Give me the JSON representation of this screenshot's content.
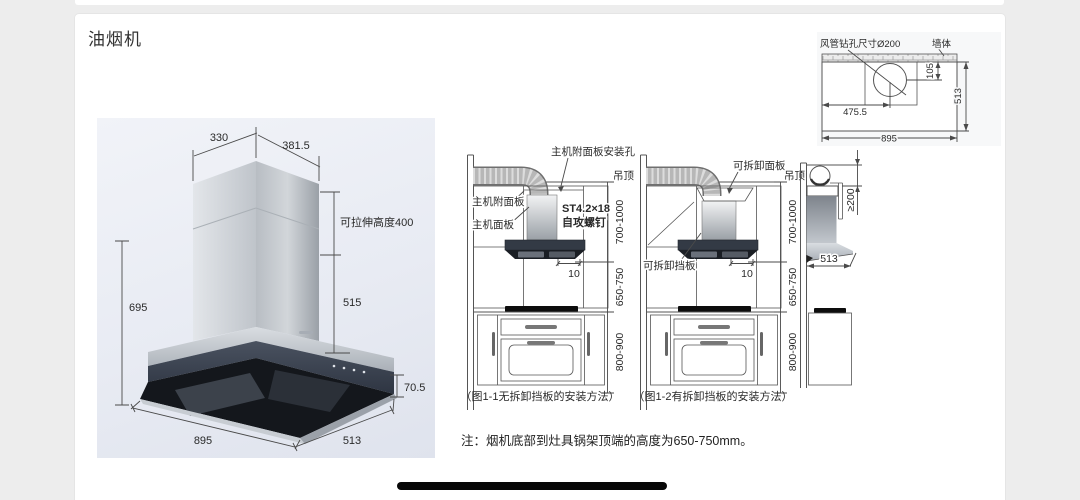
{
  "window": {
    "title": "油烟机"
  },
  "note": "注：烟机底部到灶具锅架顶端的高度为650-750mm。",
  "colors": {
    "glass": "#3a4250",
    "stainless": "#c6cad0",
    "render_bg": "#e9ecf4"
  },
  "product_render": {
    "dim_top_width": "330",
    "dim_top_depth": "381.5",
    "dim_pull_height": "可拉伸高度400",
    "dim_chimney_height": "515",
    "dim_total_height": "695",
    "dim_glass_height": "70.5",
    "dim_body_width": "895",
    "dim_body_depth": "513"
  },
  "figure1": {
    "caption": "（图1-1无拆卸挡板的安装方法）",
    "label_mount_hole": "主机附面板安装孔",
    "label_ceiling": "吊顶",
    "label_attach_panel": "主机附面板",
    "label_main_panel": "主机面板",
    "label_screw_spec": "ST4.2×18",
    "label_screw_type": "自攻螺钉",
    "dim_gap": "10",
    "dim_ceiling_to_bottom": "700-1000",
    "dim_bottom_to_cooktop": "650-750",
    "dim_counter_height": "800-900"
  },
  "figure2": {
    "caption": "（图1-2有拆卸挡板的安装方法）",
    "label_removable_panel": "可拆卸面板",
    "label_ceiling": "吊顶",
    "label_removable_baffle": "可拆卸挡板",
    "dim_gap": "10",
    "dim_ceiling_to_bottom": "700-1000",
    "dim_bottom_to_cooktop": "650-750",
    "dim_counter_height": "800-900"
  },
  "side_view": {
    "dim_clearance": "≥200",
    "dim_depth": "513"
  },
  "top_view": {
    "label_hole": "风管钻孔尺寸Ø200",
    "label_wall": "墙体",
    "dim_offset_x": "475.5",
    "dim_offset_y": "105",
    "dim_depth": "513",
    "dim_width": "895"
  }
}
